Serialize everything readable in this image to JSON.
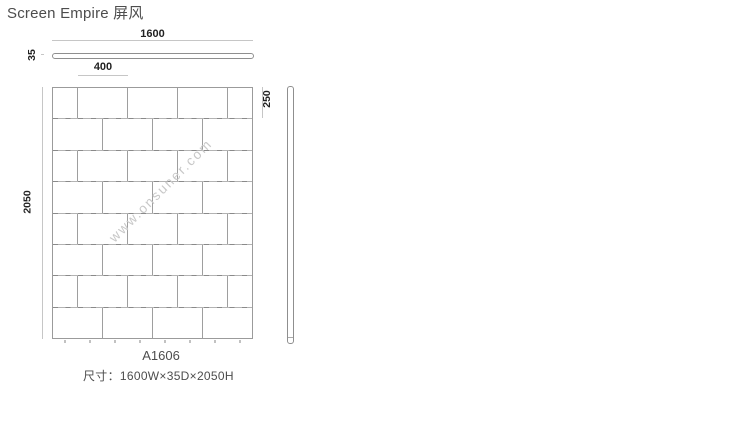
{
  "title": "Screen Empire 屏风",
  "product": {
    "model": "A1606",
    "size_label": "尺寸：1600W×35D×2050H"
  },
  "dimensions": {
    "overall_width": "1600",
    "depth": "35",
    "overall_height": "2050",
    "brick_width": "400",
    "brick_height": "250"
  },
  "watermark": "www.onsuner.com",
  "drawing": {
    "panel_width_mm": 1600,
    "rows": [
      [
        200,
        400,
        400,
        400,
        200
      ],
      [
        400,
        400,
        400,
        400
      ],
      [
        200,
        400,
        400,
        400,
        200
      ],
      [
        400,
        400,
        400,
        400
      ],
      [
        200,
        400,
        400,
        400,
        200
      ],
      [
        400,
        400,
        400,
        400
      ],
      [
        200,
        400,
        400,
        400,
        200
      ],
      [
        400,
        400,
        400,
        400
      ]
    ],
    "feet_positions_mm": [
      100,
      300,
      500,
      700,
      900,
      1100,
      1300,
      1500
    ]
  },
  "colors": {
    "brick_line": "#9e9e9e",
    "dim_line": "#c6c6c6",
    "text": "#4d4d4d",
    "dim_text": "#222222",
    "watermark_text": "#c8c8c8"
  }
}
